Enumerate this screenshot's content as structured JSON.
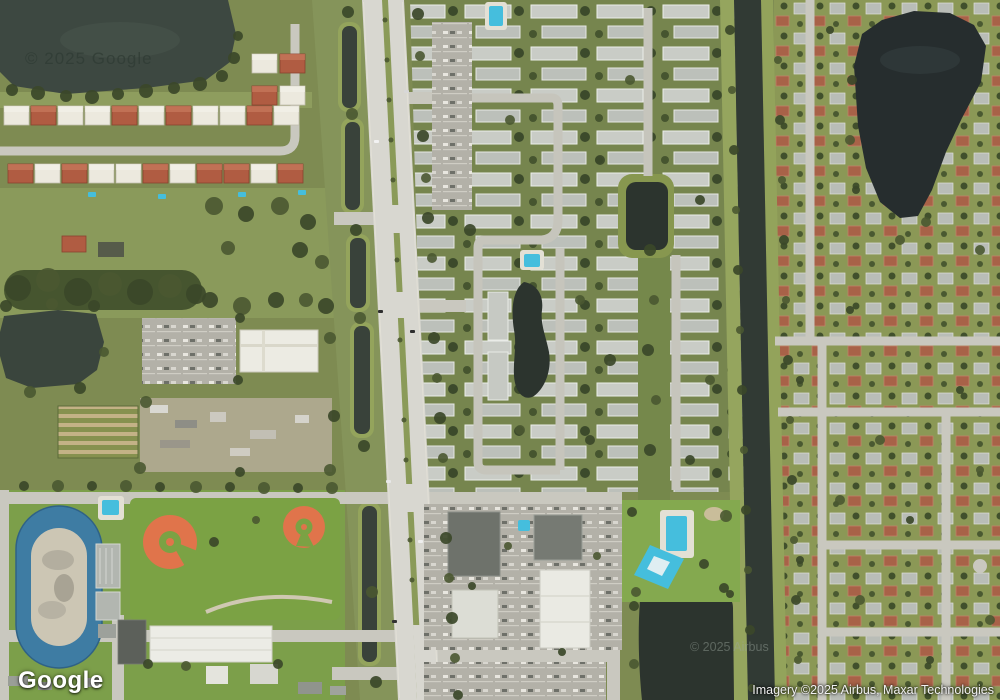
{
  "overlays": {
    "logo_text": "Google",
    "attribution_text": "Imagery ©2025 Airbus, Maxar Technologies",
    "lake_watermark_text": "© 2025 Google",
    "pond_watermark_text": "© 2025 Airbus"
  },
  "view": {
    "type": "satellite"
  },
  "colors": {
    "vegetation_base": "#7e8b52",
    "vegetation_bright": "#7ba244",
    "tree_dark": "#3b4829",
    "road_major": "#d8d7d0",
    "road_minor": "#c9c8bf",
    "water_lake": "#3d4841",
    "water_lake_dark": "#262d2e",
    "water_canal": "#313a34",
    "water_pond": "#2c342e",
    "pool_cyan": "#45bedd",
    "roof_light_gray": "#c9ccc6",
    "roof_white": "#ece9de",
    "roof_terracotta": "#b05c42",
    "baseball_clay": "#e0744b",
    "track_blue": "#3e7ca3",
    "track_infield": "#ccc6b4"
  }
}
